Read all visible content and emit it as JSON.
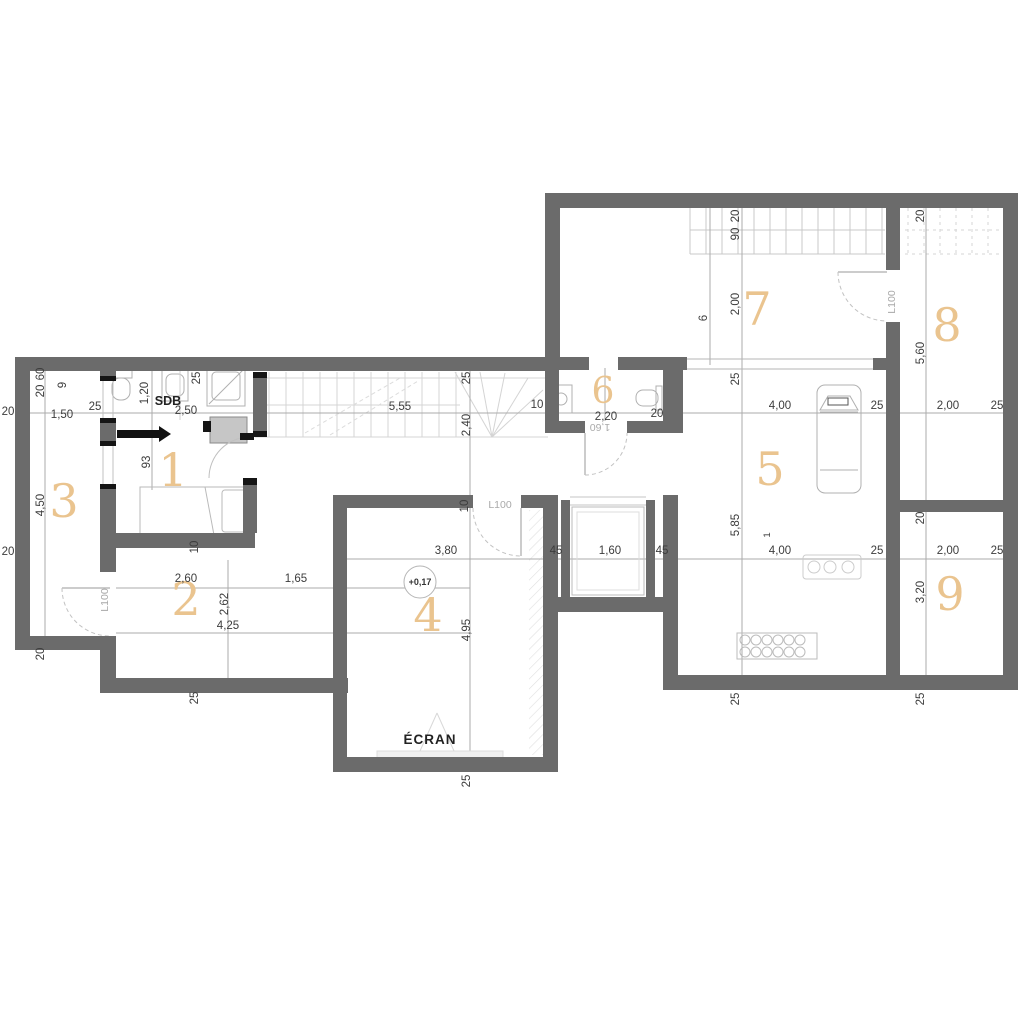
{
  "palette": {
    "wall": "#6b6b6b",
    "accent": "#eac48f",
    "dim_text": "#3c3c3c",
    "muted_text": "#a9a9a9",
    "window_cap": "#151515",
    "fixture_line": "#b5b5b5"
  },
  "rooms": [
    {
      "id": "room-1",
      "number": "1"
    },
    {
      "id": "room-2",
      "number": "2"
    },
    {
      "id": "room-3",
      "number": "3"
    },
    {
      "id": "room-4",
      "number": "4"
    },
    {
      "id": "room-5",
      "number": "5"
    },
    {
      "id": "room-6",
      "number": "6"
    },
    {
      "id": "room-7",
      "number": "7"
    },
    {
      "id": "room-8",
      "number": "8"
    },
    {
      "id": "room-9",
      "number": "9"
    }
  ],
  "texts": {
    "sdb": "SDB",
    "ecran": "ÉCRAN",
    "level_marker": "+0,17",
    "door": "L100",
    "door_width_flipped": "1,60"
  },
  "dims": [
    {
      "text": "60"
    },
    {
      "text": "20"
    },
    {
      "text": "9"
    },
    {
      "text": "20"
    },
    {
      "text": "1,50"
    },
    {
      "text": "25"
    },
    {
      "text": "1,20"
    },
    {
      "text": "2,50"
    },
    {
      "text": "25"
    },
    {
      "text": "25"
    },
    {
      "text": "5,55"
    },
    {
      "text": "2,40"
    },
    {
      "text": "10"
    },
    {
      "text": "20"
    },
    {
      "text": "4,50"
    },
    {
      "text": "93"
    },
    {
      "text": "10"
    },
    {
      "text": "2,60"
    },
    {
      "text": "1,65"
    },
    {
      "text": "2,62"
    },
    {
      "text": "4,25"
    },
    {
      "text": "20"
    },
    {
      "text": "25"
    },
    {
      "text": "10"
    },
    {
      "text": "3,80"
    },
    {
      "text": "45"
    },
    {
      "text": "1,60"
    },
    {
      "text": "45"
    },
    {
      "text": "4,95"
    },
    {
      "text": "25"
    },
    {
      "text": "2,20"
    },
    {
      "text": "20"
    },
    {
      "text": "20"
    },
    {
      "text": "90"
    },
    {
      "text": "6"
    },
    {
      "text": "2,00"
    },
    {
      "text": "25"
    },
    {
      "text": "20"
    },
    {
      "text": "5,60"
    },
    {
      "text": "4,00"
    },
    {
      "text": "25"
    },
    {
      "text": "2,00"
    },
    {
      "text": "25"
    },
    {
      "text": "5,85"
    },
    {
      "text": "1"
    },
    {
      "text": "4,00"
    },
    {
      "text": "25"
    },
    {
      "text": "20"
    },
    {
      "text": "2,00"
    },
    {
      "text": "25"
    },
    {
      "text": "3,20"
    },
    {
      "text": "25"
    },
    {
      "text": "25"
    }
  ]
}
